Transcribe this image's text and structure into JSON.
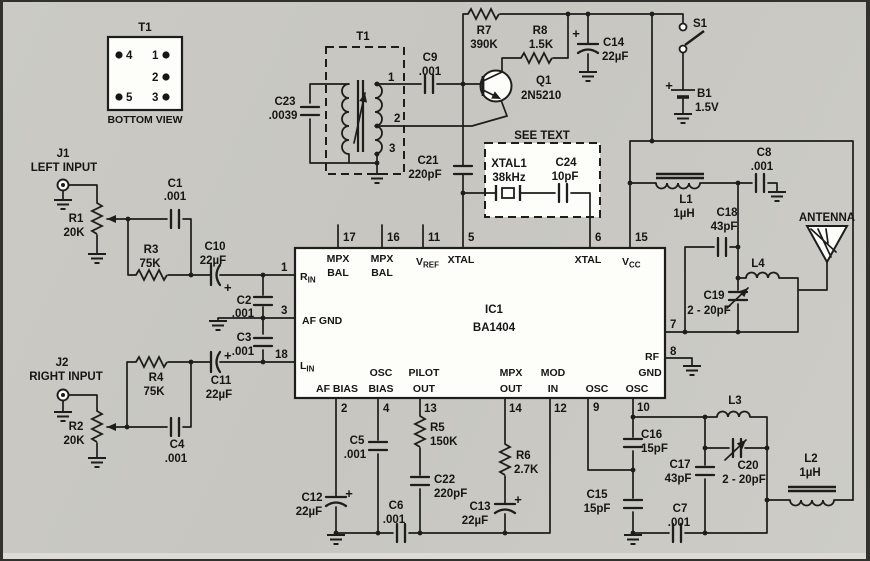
{
  "detail": {
    "ref": "T1",
    "view": "BOTTOM VIEW",
    "pins": {
      "p1": "1",
      "p2": "2",
      "p3": "3",
      "p4": "4",
      "p5": "5"
    }
  },
  "t1": {
    "ref": "T1",
    "taps": {
      "t1": "1",
      "t2": "2",
      "t3": "3"
    }
  },
  "jacks": {
    "j1": {
      "ref": "J1",
      "label": "LEFT INPUT"
    },
    "j2": {
      "ref": "J2",
      "label": "RIGHT INPUT"
    }
  },
  "parts": {
    "r1": {
      "ref": "R1",
      "value": "20K"
    },
    "r2": {
      "ref": "R2",
      "value": "20K"
    },
    "r3": {
      "ref": "R3",
      "value": "75K"
    },
    "r4": {
      "ref": "R4",
      "value": "75K"
    },
    "r5": {
      "ref": "R5",
      "value": "150K"
    },
    "r6": {
      "ref": "R6",
      "value": "2.7K"
    },
    "r7": {
      "ref": "R7",
      "value": "390K"
    },
    "r8": {
      "ref": "R8",
      "value": "1.5K"
    },
    "c1": {
      "ref": "C1",
      "value": ".001"
    },
    "c2": {
      "ref": "C2",
      "value": ".001"
    },
    "c3": {
      "ref": "C3",
      "value": ".001"
    },
    "c4": {
      "ref": "C4",
      "value": ".001"
    },
    "c5": {
      "ref": "C5",
      "value": ".001"
    },
    "c6": {
      "ref": "C6",
      "value": ".001"
    },
    "c7": {
      "ref": "C7",
      "value": ".001"
    },
    "c8": {
      "ref": "C8",
      "value": ".001"
    },
    "c9": {
      "ref": "C9",
      "value": ".001"
    },
    "c10": {
      "ref": "C10",
      "value": "22µF"
    },
    "c11": {
      "ref": "C11",
      "value": "22µF"
    },
    "c12": {
      "ref": "C12",
      "value": "22µF"
    },
    "c13": {
      "ref": "C13",
      "value": "22µF"
    },
    "c14": {
      "ref": "C14",
      "value": "22µF"
    },
    "c15": {
      "ref": "C15",
      "value": "15pF"
    },
    "c16": {
      "ref": "C16",
      "value": "15pF"
    },
    "c17": {
      "ref": "C17",
      "value": "43pF"
    },
    "c18": {
      "ref": "C18",
      "value": "43pF"
    },
    "c19": {
      "ref": "C19",
      "value": "2 - 20pF"
    },
    "c20": {
      "ref": "C20",
      "value": "2 - 20pF"
    },
    "c21": {
      "ref": "C21",
      "value": "220pF"
    },
    "c22": {
      "ref": "C22",
      "value": "220pF"
    },
    "c23": {
      "ref": "C23",
      "value": ".0039"
    },
    "c24": {
      "ref": "C24",
      "value": "10pF"
    },
    "l1": {
      "ref": "L1",
      "value": "1µH"
    },
    "l2": {
      "ref": "L2",
      "value": "1µH"
    },
    "l3": {
      "ref": "L3"
    },
    "l4": {
      "ref": "L4"
    },
    "q1": {
      "ref": "Q1",
      "value": "2N5210"
    },
    "b1": {
      "ref": "B1",
      "value": "1.5V"
    },
    "s1": {
      "ref": "S1"
    },
    "xtal1": {
      "ref": "XTAL1",
      "value": "38kHz"
    }
  },
  "ic": {
    "ref": "IC1",
    "part": "BA1404",
    "pins": {
      "n1": "1",
      "n2": "2",
      "n3": "3",
      "n4": "4",
      "n5": "5",
      "n6": "6",
      "n7": "7",
      "n8": "8",
      "n9": "9",
      "n10": "10",
      "n11": "11",
      "n12": "12",
      "n13": "13",
      "n14": "14",
      "n15": "15",
      "n16": "16",
      "n17": "17",
      "n18": "18"
    },
    "names": {
      "rin_main": "R",
      "rin_sub": "IN",
      "lin_main": "L",
      "lin_sub": "IN",
      "vref_main": "V",
      "vref_sub": "REF",
      "vcc_main": "V",
      "vcc_sub": "CC",
      "mpx": "MPX",
      "bal": "BAL",
      "xtal": "XTAL",
      "af_gnd": "AF GND",
      "af_bias": "AF BIAS",
      "osc": "OSC",
      "bias": "BIAS",
      "pilot": "PILOT",
      "out": "OUT",
      "mod": "MOD",
      "in": "IN",
      "rf": "RF",
      "gnd": "GND"
    }
  },
  "labels": {
    "see_text": "SEE TEXT",
    "antenna": "ANTENNA",
    "plus": "+"
  }
}
